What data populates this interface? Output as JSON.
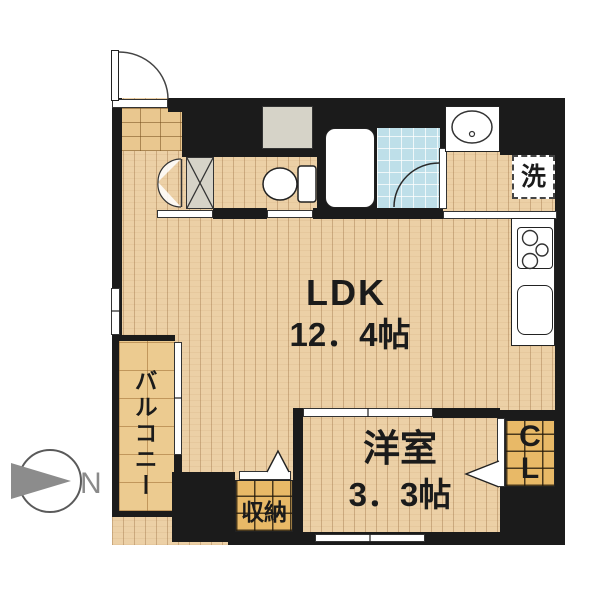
{
  "plan": {
    "type": "apartment-floor-plan",
    "rooms": {
      "ldk": {
        "name": "LDK",
        "size": "12．4帖"
      },
      "western_room": {
        "name": "洋室",
        "size": "3．3帖"
      },
      "balcony": {
        "name": "バルコニー"
      },
      "storage": {
        "name": "収納"
      },
      "closet": {
        "lines": [
          "C",
          "L"
        ]
      },
      "washer_space": {
        "label": "洗"
      }
    },
    "fixtures": [
      "entrance-door",
      "shoe-closet-double-door",
      "toilet",
      "bathtub",
      "bathroom",
      "washbasin",
      "washing-machine-space",
      "kitchen-stove",
      "kitchen-sink",
      "sliding-doors",
      "windows"
    ],
    "compass": {
      "label": "N",
      "direction": "right"
    },
    "colors": {
      "wall": "#1b1b1b",
      "wood_floor": "#ecd0a6",
      "entrance_tile": "#e9c78f",
      "balcony_tile": "#eccb90",
      "closet_shelf": "#e8b967",
      "bathroom_tile": "#bedfe9",
      "counter_gray": "#d6d3c8",
      "compass_gray": "#8c8c8c"
    }
  }
}
